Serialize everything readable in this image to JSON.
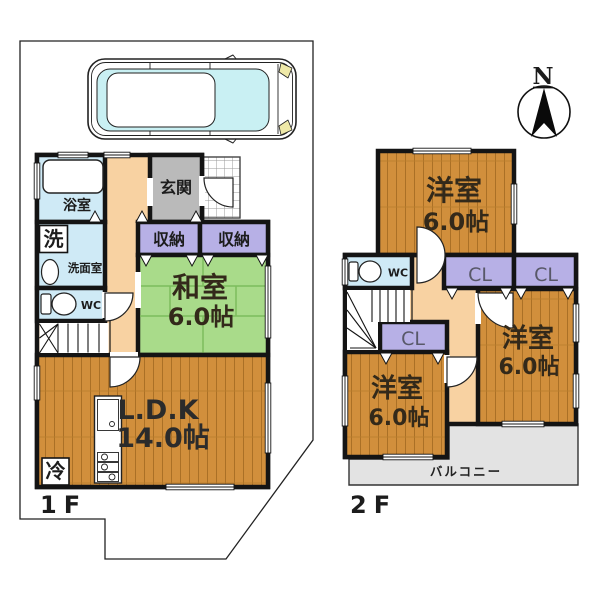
{
  "compass": {
    "north": "N"
  },
  "f1": {
    "label": "1F",
    "bath": "浴室",
    "washer": "洗",
    "washroom": "洗面室",
    "wc": "WC",
    "entrance": "玄関",
    "closet1": "収納",
    "closet2": "収納",
    "jroom": "和室",
    "jroom_size": "6.0帖",
    "ldk": "L.D.K",
    "ldk_size": "14.0帖",
    "fridge": "冷"
  },
  "f2": {
    "label": "2F",
    "wc": "WC",
    "cl1": "CL",
    "cl2": "CL",
    "cl3": "CL",
    "room_top": "洋室",
    "room_top_size": "6.0帖",
    "room_right": "洋室",
    "room_right_size": "6.0帖",
    "room_left": "洋室",
    "room_left_size": "6.0帖",
    "balcony": "バルコニー"
  },
  "colors": {
    "wood": "#d18f3c",
    "wood_stripe": "#aa7026",
    "tatami": "#a9db8a",
    "tatami_line": "#7cbd5c",
    "closet": "#b7b0e6",
    "water": "#cfeaf6",
    "hallway": "#f8d2a2",
    "entrance": "#bababa",
    "balcony": "#e3e3e3",
    "wall": "#141414",
    "car_glass": "#c9f0f3",
    "headlight": "#efe9a8",
    "boundary": "#222222"
  }
}
